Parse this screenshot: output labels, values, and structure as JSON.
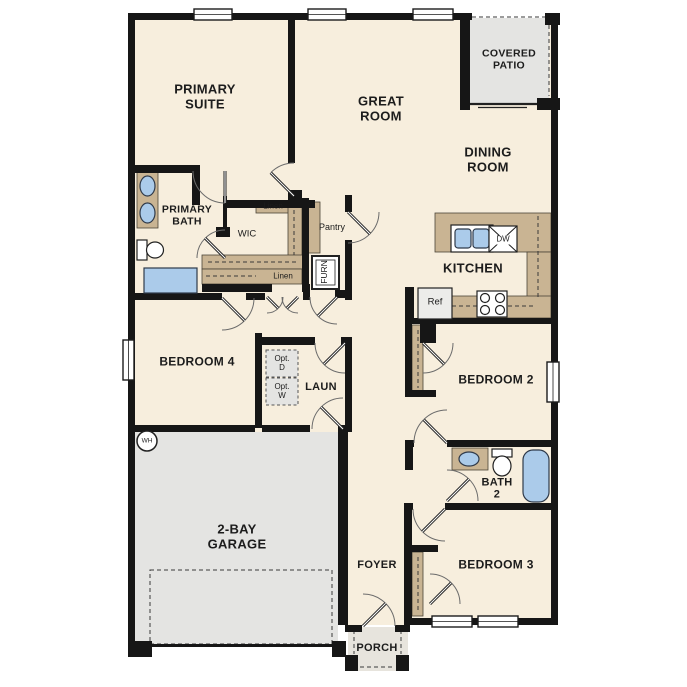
{
  "title": "Single-story floor plan",
  "colors": {
    "background": "#ffffff",
    "floor": "#f7eedd",
    "counter": "#c9b493",
    "slab": "#e4e4e2",
    "porch_slab": "#e7e4dd",
    "fixture": "#abcbea",
    "wall": "#161616",
    "opt_box": "#e4e4e2",
    "appliance": "#ececea",
    "text": "#1c1c1c"
  },
  "labels": {
    "primary_suite": "PRIMARY\nSUITE",
    "great_room": "GREAT\nROOM",
    "covered_patio": "COVERED\nPATIO",
    "dining_room": "DINING\nROOM",
    "kitchen": "KITCHEN",
    "primary_bath": "PRIMARY\nBATH",
    "wic": "WIC",
    "linen_top": "Linen",
    "linen_bottom": "Linen",
    "pantry": "Pantry",
    "furn": "FURN",
    "bedroom4": "BEDROOM 4",
    "laundry": "LAUN",
    "opt_d": "Opt.\nD",
    "opt_w": "Opt.\nW",
    "garage": "2-BAY\nGARAGE",
    "water_heater": "WH",
    "bedroom2": "BEDROOM 2",
    "bath2": "BATH\n2",
    "bedroom3": "BEDROOM 3",
    "foyer": "FOYER",
    "porch": "PORCH",
    "ref": "Ref",
    "dw": "DW"
  }
}
